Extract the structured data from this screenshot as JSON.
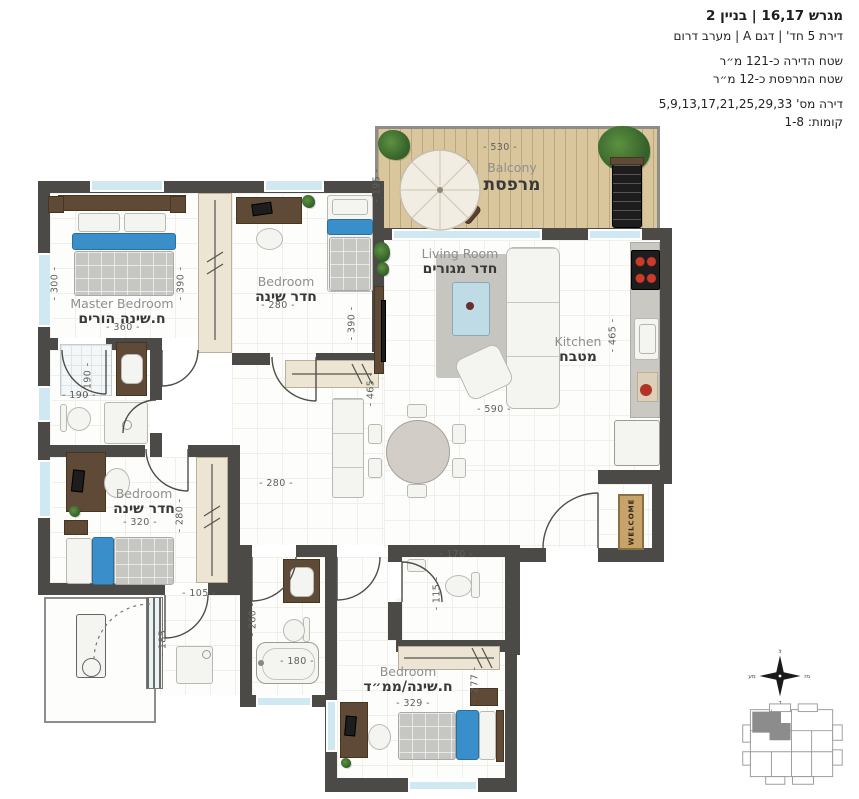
{
  "header": {
    "title": "מגרש 16,17 | בניין 2",
    "subtitle": "דירת 5 חד' | דגם A | מערב דרום",
    "area_apartment": "שטח הדירה כ-121 מ״ר",
    "area_balcony": "שטח המרפסת כ-12 מ״ר",
    "apartment_numbers": "דירה מס'  5,9,13,17,21,25,29,33",
    "floors": "קומות:  1-8"
  },
  "rooms": {
    "balcony": {
      "en": "Balcony",
      "he": "מרפסת"
    },
    "master": {
      "en": "Master Bedroom",
      "he": "ח.שינה הורים"
    },
    "bedroom2": {
      "en": "Bedroom",
      "he": "חדר שינה"
    },
    "living": {
      "en": "Living Room",
      "he": "חדר מגורים"
    },
    "kitchen": {
      "en": "Kitchen",
      "he": "מטבח"
    },
    "bedroom3": {
      "en": "Bedroom",
      "he": "חדר שינה"
    },
    "mamad": {
      "en": "Bedroom",
      "he": "ח.שינה/ממ״ד"
    }
  },
  "dims": {
    "balcony_w": "- 530 -",
    "balcony_h": "- 195 -",
    "master_side": "- 300 -",
    "master_inner": "- 390 -",
    "master_w": "- 360 -",
    "bedroom2_w": "- 280 -",
    "bedroom2_side": "- 390 -",
    "bath1_v": "- 190 -",
    "bath1_h": "- 190 -",
    "bedroom3_w": "- 320 -",
    "bedroom3_side": "- 280 -",
    "hall_w": "- 280 -",
    "living_side": "- 465 -",
    "living_w": "- 590 -",
    "kitchen_side": "- 465 -",
    "laundry_w": "- 105 -",
    "laundry_h": "- 185 -",
    "bath2_h": "- 260 -",
    "bath2_w": "- 180 -",
    "wc_w": "- 170 -",
    "wc_h": "- 115 -",
    "mamad_w": "- 329 -",
    "mamad_side": "- 277 -"
  },
  "entrance": {
    "mat": "WELCOME"
  },
  "compass": {
    "n": "צ",
    "e": "מז",
    "s": "ד",
    "w": "מע"
  },
  "watermark": "neamal"
}
